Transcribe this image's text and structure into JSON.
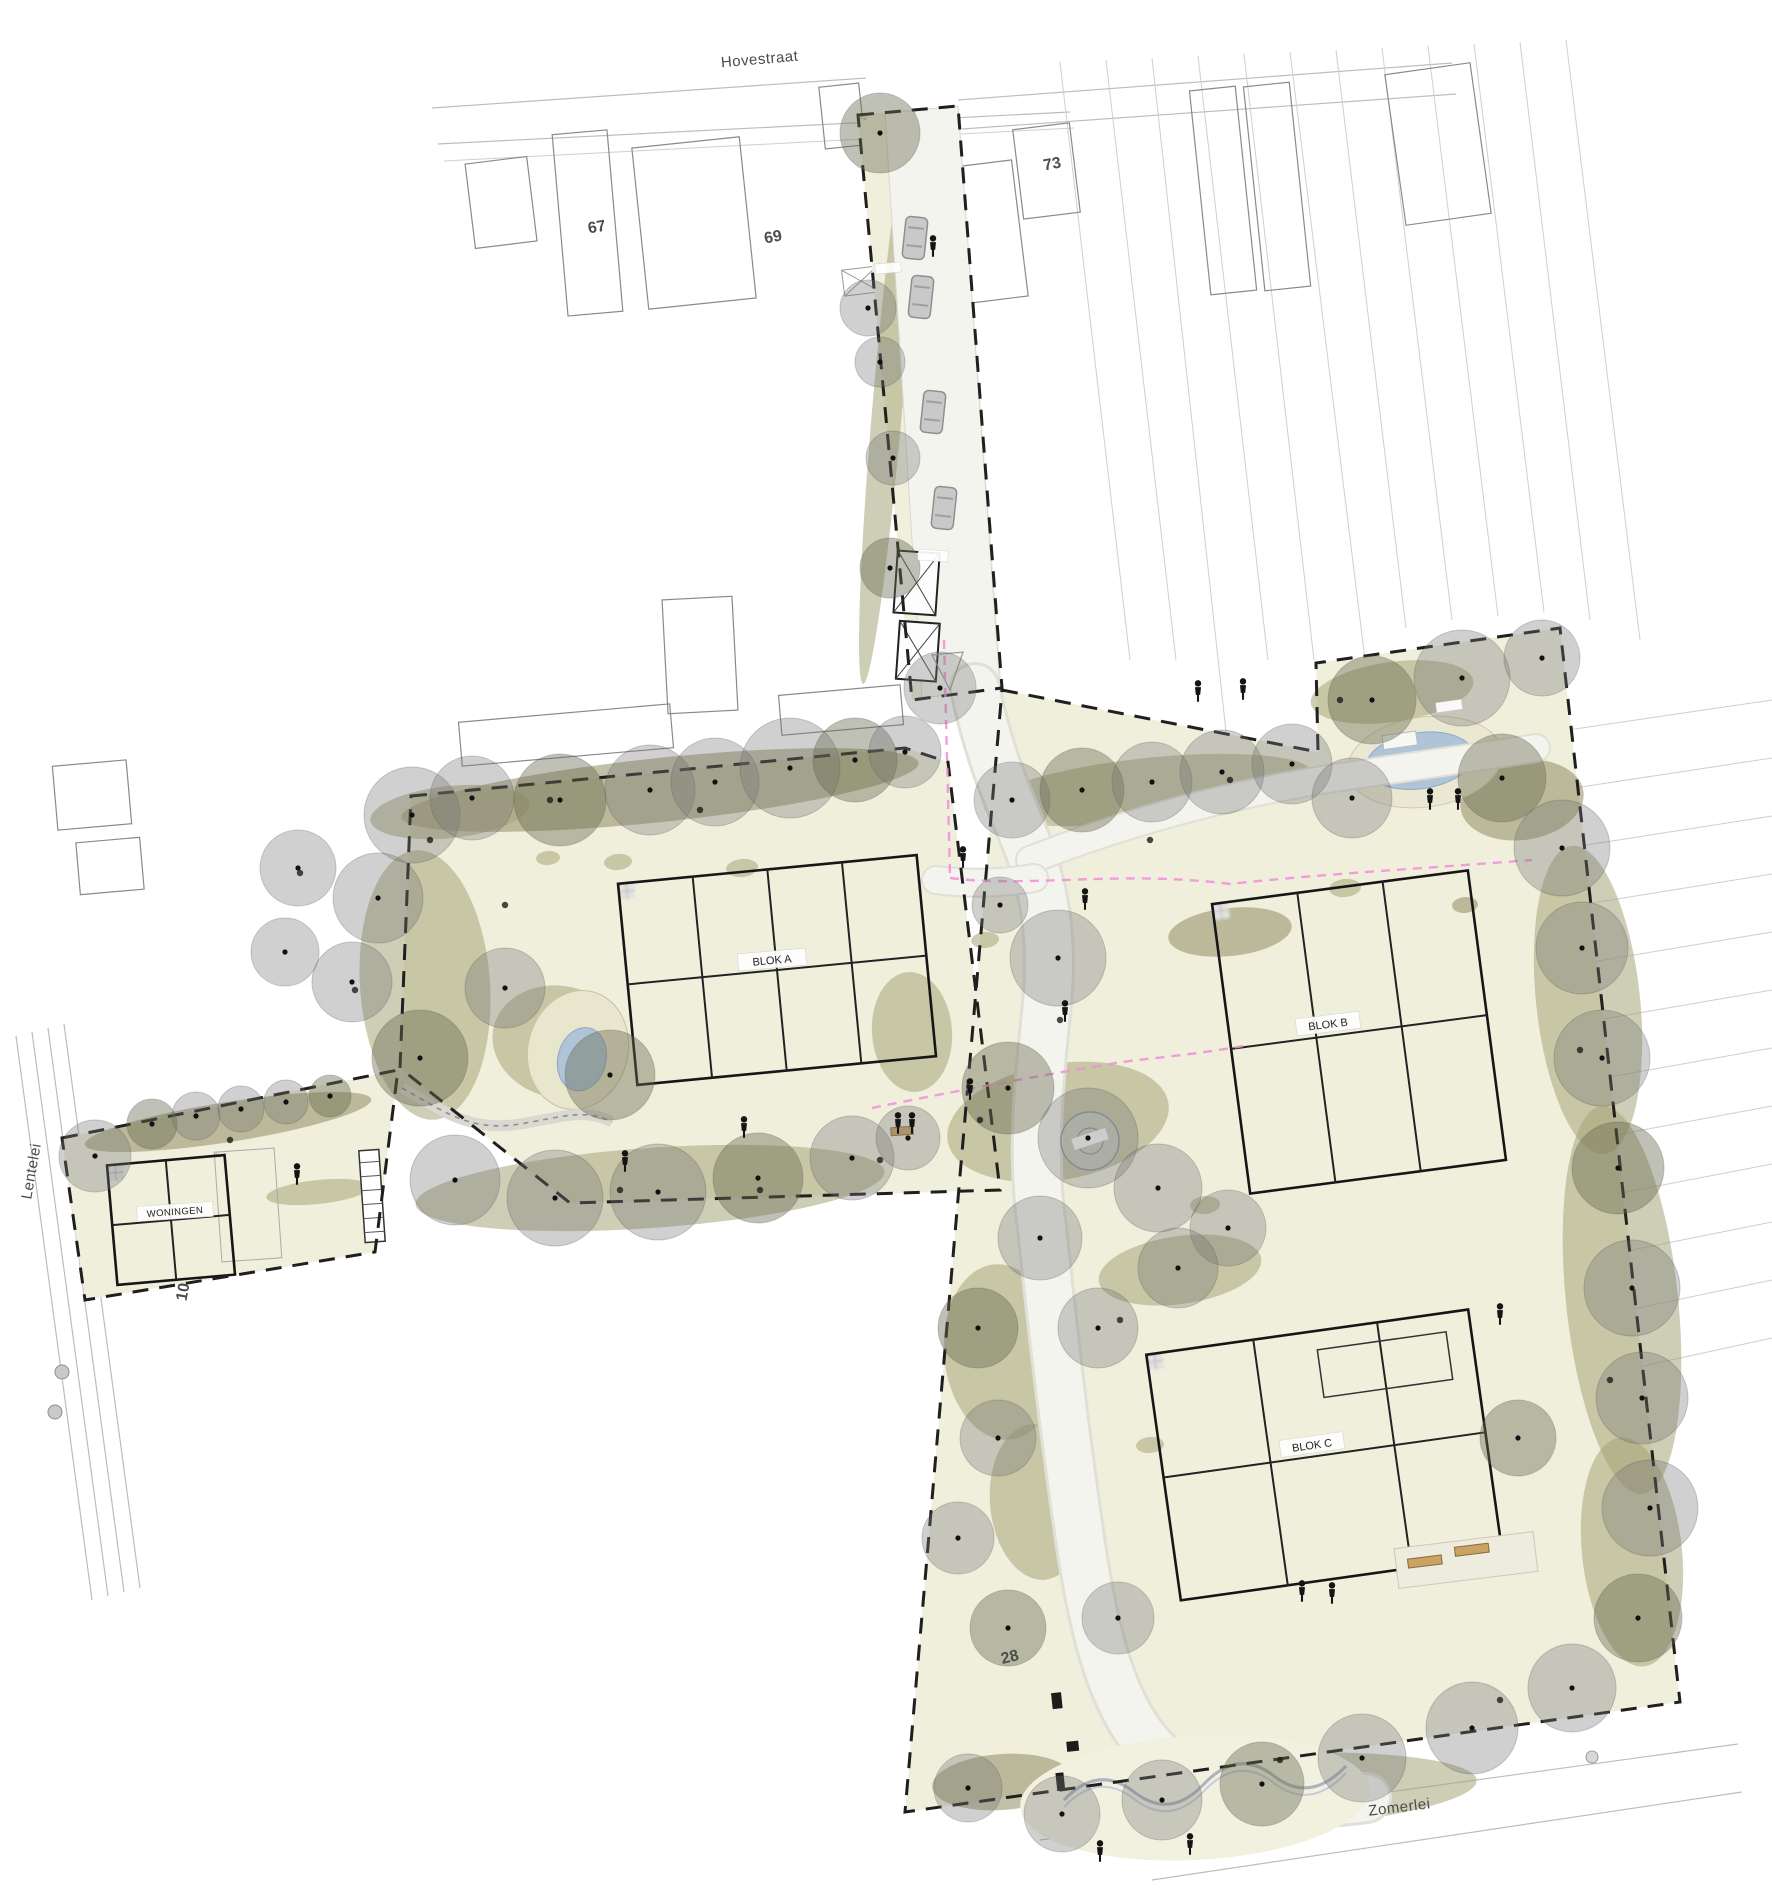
{
  "drawing_labels": {
    "street_top": "Hovestraat",
    "street_left": "Lentelei",
    "street_bottom": "Zomerlei",
    "house_numbers": {
      "n67": "67",
      "n69": "69",
      "n73": "73",
      "n10": "10",
      "n28": "28"
    },
    "block_a": "BLOK A",
    "block_b": "BLOK B",
    "block_c": "BLOK C",
    "woningen_label": "WONINGEN"
  },
  "colors": {
    "parcel_fill": "#f0efdc",
    "shrub": "#a6a478",
    "shrub_dark": "#8f8d63",
    "tree_canopy": "rgba(116,116,116,0.34)",
    "tree_canopy_olive": "rgba(104,108,82,0.42)",
    "tree_stroke": "rgba(85,85,85,0.28)",
    "boundary": "#1f1f1f",
    "phase_line": "#ef8fd8",
    "water": "#b0c4d8",
    "road": "#f4f4ef",
    "building_fill": "#e3e3e1",
    "bench": "#caa264"
  },
  "plan": {
    "trees": [
      [
        880,
        133,
        40
      ],
      [
        868,
        308,
        28
      ],
      [
        880,
        362,
        25
      ],
      [
        893,
        458,
        27
      ],
      [
        890,
        568,
        30
      ],
      [
        940,
        688,
        36
      ],
      [
        412,
        815,
        48
      ],
      [
        472,
        798,
        42
      ],
      [
        560,
        800,
        46
      ],
      [
        650,
        790,
        45
      ],
      [
        715,
        782,
        44
      ],
      [
        790,
        768,
        50
      ],
      [
        855,
        760,
        42
      ],
      [
        905,
        752,
        36
      ],
      [
        378,
        898,
        45
      ],
      [
        352,
        982,
        40
      ],
      [
        420,
        1058,
        48
      ],
      [
        298,
        868,
        38
      ],
      [
        285,
        952,
        34
      ],
      [
        505,
        988,
        40
      ],
      [
        610,
        1075,
        45
      ],
      [
        455,
        1180,
        45
      ],
      [
        555,
        1198,
        48
      ],
      [
        658,
        1192,
        48
      ],
      [
        758,
        1178,
        45
      ],
      [
        852,
        1158,
        42
      ],
      [
        908,
        1138,
        32
      ],
      [
        95,
        1156,
        36
      ],
      [
        152,
        1124,
        25
      ],
      [
        196,
        1116,
        24
      ],
      [
        241,
        1109,
        23
      ],
      [
        286,
        1102,
        22
      ],
      [
        330,
        1096,
        21
      ],
      [
        1058,
        958,
        48
      ],
      [
        1000,
        905,
        28
      ],
      [
        1012,
        800,
        38
      ],
      [
        1082,
        790,
        42
      ],
      [
        1152,
        782,
        40
      ],
      [
        1222,
        772,
        42
      ],
      [
        1292,
        764,
        40
      ],
      [
        1372,
        700,
        44
      ],
      [
        1462,
        678,
        48
      ],
      [
        1542,
        658,
        38
      ],
      [
        1352,
        798,
        40
      ],
      [
        1502,
        778,
        44
      ],
      [
        1562,
        848,
        48
      ],
      [
        1582,
        948,
        46
      ],
      [
        1602,
        1058,
        48
      ],
      [
        1618,
        1168,
        46
      ],
      [
        1632,
        1288,
        48
      ],
      [
        1642,
        1398,
        46
      ],
      [
        1650,
        1508,
        48
      ],
      [
        1638,
        1618,
        44
      ],
      [
        1572,
        1688,
        44
      ],
      [
        1472,
        1728,
        46
      ],
      [
        1362,
        1758,
        44
      ],
      [
        1262,
        1784,
        42
      ],
      [
        1162,
        1800,
        40
      ],
      [
        1062,
        1814,
        38
      ],
      [
        968,
        1788,
        34
      ],
      [
        1008,
        1088,
        46
      ],
      [
        1088,
        1138,
        50
      ],
      [
        1158,
        1188,
        44
      ],
      [
        1040,
        1238,
        42
      ],
      [
        978,
        1328,
        40
      ],
      [
        1098,
        1328,
        40
      ],
      [
        998,
        1438,
        38
      ],
      [
        958,
        1538,
        36
      ],
      [
        1008,
        1628,
        38
      ],
      [
        1118,
        1618,
        36
      ],
      [
        1228,
        1228,
        38
      ],
      [
        1178,
        1268,
        40
      ],
      [
        1518,
        1438,
        38
      ]
    ],
    "shrubs": [
      [
        660,
        790,
        260,
        32,
        -6
      ],
      [
        450,
        812,
        80,
        26,
        -6
      ],
      [
        425,
        985,
        65,
        135,
        -4
      ],
      [
        560,
        1042,
        68,
        56,
        12
      ],
      [
        650,
        1188,
        235,
        40,
        -4
      ],
      [
        228,
        1122,
        145,
        20,
        -9
      ],
      [
        318,
        1192,
        52,
        12,
        -6
      ],
      [
        888,
        400,
        15,
        285,
        5
      ],
      [
        1148,
        790,
        165,
        32,
        -6
      ],
      [
        1392,
        692,
        82,
        30,
        -8
      ],
      [
        1522,
        800,
        62,
        40,
        -8
      ],
      [
        1588,
        1000,
        52,
        155,
        -6
      ],
      [
        1622,
        1300,
        56,
        195,
        -6
      ],
      [
        1632,
        1552,
        50,
        115,
        -6
      ],
      [
        1252,
        1792,
        225,
        38,
        -3
      ],
      [
        1002,
        1782,
        70,
        28,
        -4
      ],
      [
        1058,
        1122,
        112,
        58,
        -10
      ],
      [
        1002,
        1352,
        58,
        88,
        -5
      ],
      [
        1180,
        1270,
        82,
        34,
        -8
      ],
      [
        1038,
        1502,
        48,
        78,
        -5
      ],
      [
        1230,
        932,
        62,
        24,
        -6
      ],
      [
        912,
        1032,
        40,
        60,
        -4
      ],
      [
        742,
        868,
        16,
        9,
        -5
      ],
      [
        985,
        940,
        14,
        8,
        -5
      ],
      [
        1345,
        888,
        16,
        9,
        -5
      ],
      [
        1465,
        905,
        13,
        8,
        -5
      ],
      [
        1205,
        1205,
        15,
        9,
        -5
      ],
      [
        618,
        862,
        14,
        8,
        -5
      ],
      [
        548,
        858,
        12,
        7,
        -5
      ],
      [
        1150,
        1445,
        14,
        8,
        -5
      ]
    ],
    "people": [
      [
        933,
        247
      ],
      [
        963,
        858
      ],
      [
        1085,
        900
      ],
      [
        1065,
        1012
      ],
      [
        744,
        1128
      ],
      [
        625,
        1162
      ],
      [
        970,
        1090
      ],
      [
        898,
        1124
      ],
      [
        912,
        1124
      ],
      [
        297,
        1175
      ],
      [
        1198,
        692
      ],
      [
        1243,
        690
      ],
      [
        1430,
        800
      ],
      [
        1458,
        800
      ],
      [
        1500,
        1315
      ],
      [
        1302,
        1592
      ],
      [
        1332,
        1594
      ],
      [
        1190,
        1845
      ],
      [
        1100,
        1852
      ]
    ],
    "cars": [
      [
        915,
        238,
        6
      ],
      [
        921,
        297,
        6
      ],
      [
        933,
        412,
        6
      ],
      [
        944,
        508,
        6
      ]
    ],
    "ground_dots": [
      [
        430,
        840
      ],
      [
        300,
        873
      ],
      [
        355,
        990
      ],
      [
        230,
        1140
      ],
      [
        505,
        905
      ],
      [
        620,
        1190
      ],
      [
        760,
        1190
      ],
      [
        880,
        1160
      ],
      [
        1060,
        1020
      ],
      [
        980,
        1120
      ],
      [
        1120,
        1320
      ],
      [
        1340,
        700
      ],
      [
        1580,
        1050
      ],
      [
        1610,
        1380
      ],
      [
        1500,
        1700
      ],
      [
        1280,
        1760
      ],
      [
        1150,
        840
      ],
      [
        1230,
        780
      ],
      [
        700,
        810
      ],
      [
        550,
        800
      ]
    ]
  }
}
